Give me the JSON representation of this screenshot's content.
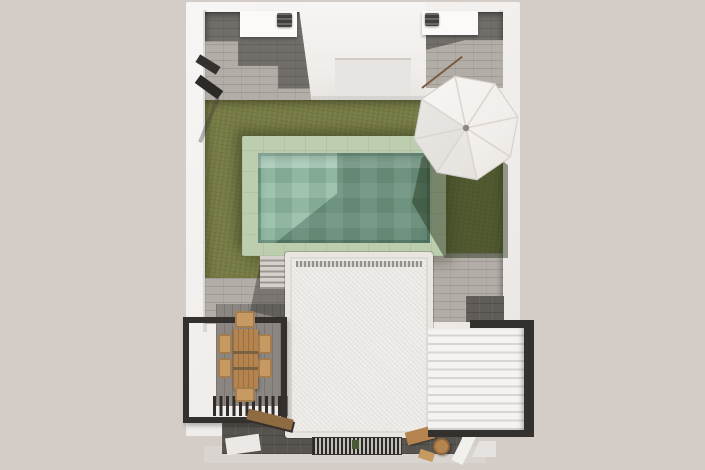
{
  "title": "Aerial top view 3D render of a modern villa roof terrace with swimming pool, lawn, white parasol, dining pergola and louvered pergola",
  "colors": {
    "bg": "#d3ccc7",
    "wall": "#f3f1ee",
    "stoneDark": "#716d69",
    "stoneLight": "#b3ada7",
    "lawn": "#767a44",
    "coping": "#bdceaf",
    "water": "#8fbaa3",
    "roof": "#f1efec",
    "steel": "#34302d",
    "wood": "#b5834e",
    "woodLight": "#c79a63",
    "pavingDark": "#57534e",
    "pavingMid": "#8b8682",
    "umbrella": "#f3f1ee",
    "ac": "#45423f",
    "apron": "#d9d4cf"
  },
  "objects": {
    "plot": "villa plot seen from above",
    "courtyard_left": "stone courtyard (left)",
    "courtyard_right": "stone courtyard (right)",
    "center_volume": "white building volume",
    "ac_box_a": "rooftop equipment platform",
    "ac_unit_a": "air-conditioning unit",
    "ac_box_b": "rooftop equipment platform",
    "ac_unit_b": "air-conditioning unit",
    "lawn": "garden lawn",
    "pool": "swimming pool",
    "pool_water": "pool water",
    "steps": "garden steps",
    "main_roof": "flat white roof of lower level",
    "umbrella": "white patio umbrella",
    "umbrella_shadow": "umbrella shadow on lawn",
    "pergola_left": "black steel pergola over dining area",
    "dining_table": "wooden outdoor dining table",
    "dining_chair": "wooden dining chair",
    "bench": "wooden bench",
    "pergola_right": "white louvered pergola roof",
    "grate": "ventilation grate",
    "outdoor_shower": "outdoor shower fixture",
    "pole": "leaning pole",
    "wood_items": "wooden stools"
  }
}
